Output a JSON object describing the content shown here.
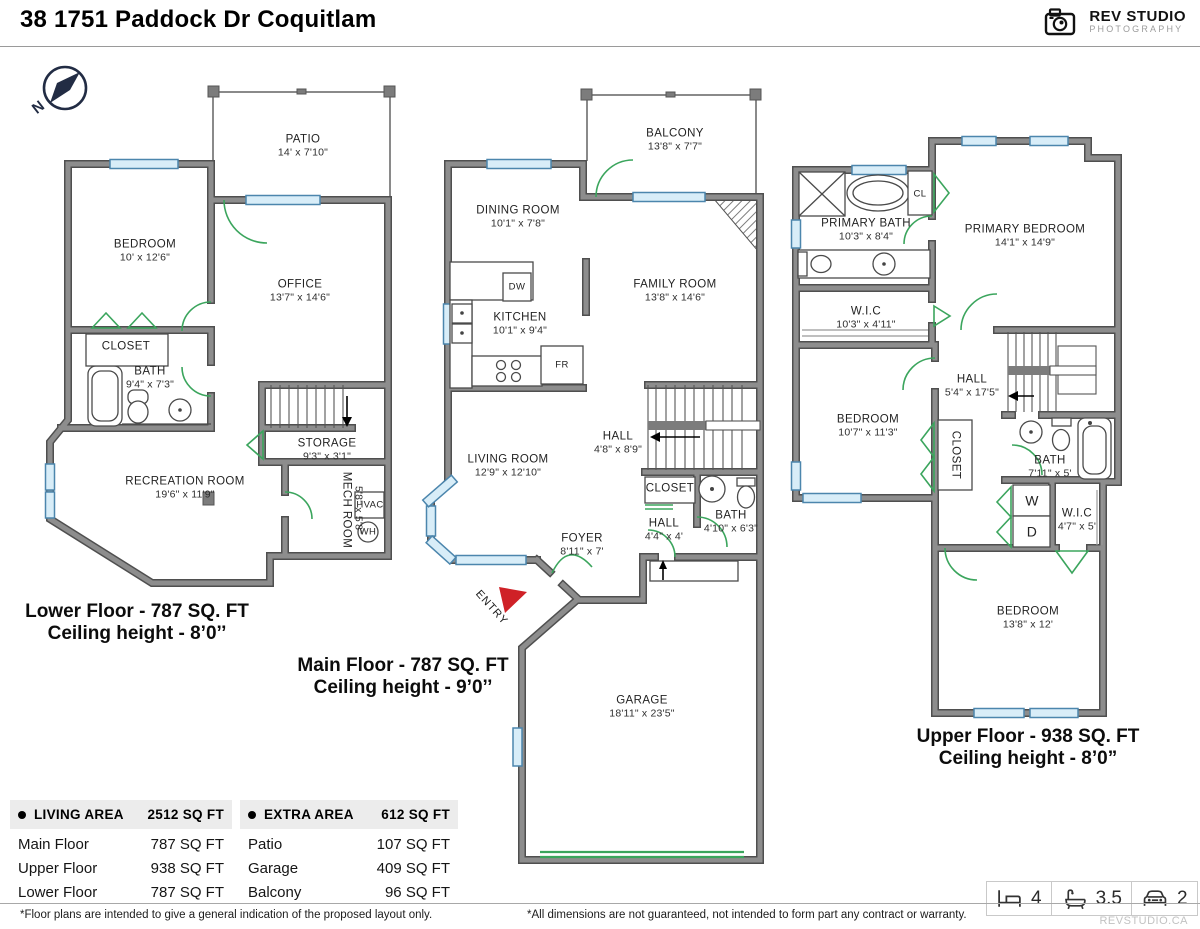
{
  "header": {
    "title": "38 1751 Paddock Dr Coquitlam",
    "logo_name": "REV STUDIO",
    "logo_sub": "PHOTOGRAPHY",
    "logo_site": "REVSTUDIO.CA"
  },
  "compass": {
    "north": "N"
  },
  "floors": {
    "lower": {
      "title": "Lower Floor - 787 SQ. FT",
      "ceiling": "Ceiling height - 8’0’’",
      "rooms": {
        "patio": {
          "name": "PATIO",
          "dims": "14' x 7'10\""
        },
        "bedroom": {
          "name": "BEDROOM",
          "dims": "10' x 12'6\""
        },
        "office": {
          "name": "OFFICE",
          "dims": "13'7\" x 14'6\""
        },
        "closet": {
          "name": "CLOSET"
        },
        "bath": {
          "name": "BATH",
          "dims": "9'4\" x 7'3\""
        },
        "storage": {
          "name": "STORAGE",
          "dims": "9'3\" x 3'1\""
        },
        "recreation": {
          "name": "RECREATION ROOM",
          "dims": "19'6\" x 11'9\""
        },
        "mech": {
          "name": "MECH ROOM",
          "dims": "5'8\" x 5'8\""
        },
        "hvac": {
          "name": "HVAC"
        },
        "wh": {
          "name": "WH"
        }
      }
    },
    "main": {
      "title": "Main Floor - 787 SQ. FT",
      "ceiling": "Ceiling height - 9’0’’",
      "rooms": {
        "balcony": {
          "name": "BALCONY",
          "dims": "13'8\" x 7'7\""
        },
        "dining": {
          "name": "DINING ROOM",
          "dims": "10'1\" x 7'8\""
        },
        "kitchen": {
          "name": "KITCHEN",
          "dims": "10'1\" x 9'4\""
        },
        "dw": {
          "name": "DW"
        },
        "fr": {
          "name": "FR"
        },
        "family": {
          "name": "FAMILY ROOM",
          "dims": "13'8\" x 14'6\""
        },
        "living": {
          "name": "LIVING ROOM",
          "dims": "12'9\" x 12'10\""
        },
        "hall_upper": {
          "name": "HALL",
          "dims": "4'8\" x 8'9\""
        },
        "closet": {
          "name": "CLOSET"
        },
        "bath": {
          "name": "BATH",
          "dims": "4'10\" x 6'3\""
        },
        "hall_lower": {
          "name": "HALL",
          "dims": "4'4\" x 4'"
        },
        "foyer": {
          "name": "FOYER",
          "dims": "8'11\" x 7'"
        },
        "entry": {
          "name": "ENTRY"
        },
        "garage": {
          "name": "GARAGE",
          "dims": "18'11\" x 23'5\""
        }
      }
    },
    "upper": {
      "title": "Upper Floor - 938 SQ. FT",
      "ceiling": "Ceiling height - 8’0”",
      "rooms": {
        "primary_bath": {
          "name": "PRIMARY BATH",
          "dims": "10'3\" x 8'4\""
        },
        "cl": {
          "name": "CL"
        },
        "primary_bedroom": {
          "name": "PRIMARY BEDROOM",
          "dims": "14'1\" x 14'9\""
        },
        "wic_main": {
          "name": "W.I.C",
          "dims": "10'3\" x 4'11\""
        },
        "bedroom_left": {
          "name": "BEDROOM",
          "dims": "10'7\" x 11'3\""
        },
        "hall": {
          "name": "HALL",
          "dims": "5'4\" x 17'5\""
        },
        "closet": {
          "name": "CLOSET"
        },
        "bath": {
          "name": "BATH",
          "dims": "7'11\" x 5'"
        },
        "washer": {
          "name": "W"
        },
        "dryer": {
          "name": "D"
        },
        "wic_small": {
          "name": "W.I.C",
          "dims": "4'7\" x 5'"
        },
        "bedroom_back": {
          "name": "BEDROOM",
          "dims": "13'8\" x 12'"
        }
      }
    }
  },
  "tables": {
    "living": {
      "header": "LIVING AREA",
      "total": "2512 SQ FT",
      "rows": [
        [
          "Main Floor",
          "787 SQ FT"
        ],
        [
          "Upper Floor",
          "938 SQ FT"
        ],
        [
          "Lower Floor",
          "787 SQ FT"
        ]
      ]
    },
    "extra": {
      "header": "EXTRA AREA",
      "total": "612 SQ FT",
      "rows": [
        [
          "Patio",
          "107 SQ FT"
        ],
        [
          "Garage",
          "409 SQ FT"
        ],
        [
          "Balcony",
          "96 SQ FT"
        ]
      ]
    }
  },
  "stats": {
    "beds": "4",
    "baths": "3.5",
    "cars": "2"
  },
  "footnotes": {
    "left": "*Floor plans are intended to give a general indication of the proposed layout only.",
    "center": "*All dimensions are not guaranteed, not intended to form part any contract or warranty."
  },
  "colors": {
    "wall": "#8d8d8d",
    "window": "#d8edf8",
    "door": "#3ba55d",
    "entry": "#cf2127"
  }
}
